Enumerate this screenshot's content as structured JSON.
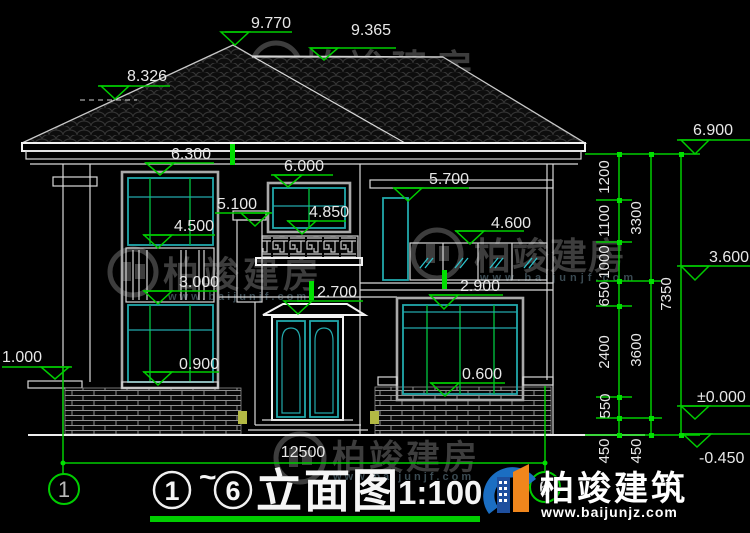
{
  "watermark": {
    "brand": "柏竣建房",
    "url": "www.baijunjf.com"
  },
  "logo": {
    "brand": "柏竣建筑",
    "url": "www.baijunjz.com"
  },
  "title_block": {
    "axis_start": "1",
    "tilde": "~",
    "axis_end": "6",
    "title": "立面图",
    "scale": "1:100"
  },
  "axis_bubbles": {
    "left": "1",
    "right": "6"
  },
  "elevations": {
    "roof_peak": "9.770",
    "roof_ridge": "9.365",
    "roof_hip": "8.326",
    "eave_left": "6.300",
    "balcony_window_top": "6.000",
    "right_lintel": "5.700",
    "balcony_beam": "5.100",
    "balcony_window_sill": "4.850",
    "right_window2_sill": "4.600",
    "left_window2_sill": "4.500",
    "left_spandrel": "3.000",
    "door_canopy": "2.700",
    "right_window_top": "2.900",
    "left_window1_sill": "0.900",
    "right_window1_sill": "0.600",
    "left_plinth": "1.000",
    "eave_right": "6.900",
    "floor2": "3.600",
    "ground": "±0.000",
    "grade": "-0.450"
  },
  "dimensions": {
    "chain_inner": [
      "1200",
      "1100",
      "1000",
      "650",
      "2400",
      "550",
      "450"
    ],
    "chain_mid": [
      "3300",
      "3600",
      "450"
    ],
    "chain_outer": [
      "7350"
    ],
    "total_width": "12500"
  }
}
